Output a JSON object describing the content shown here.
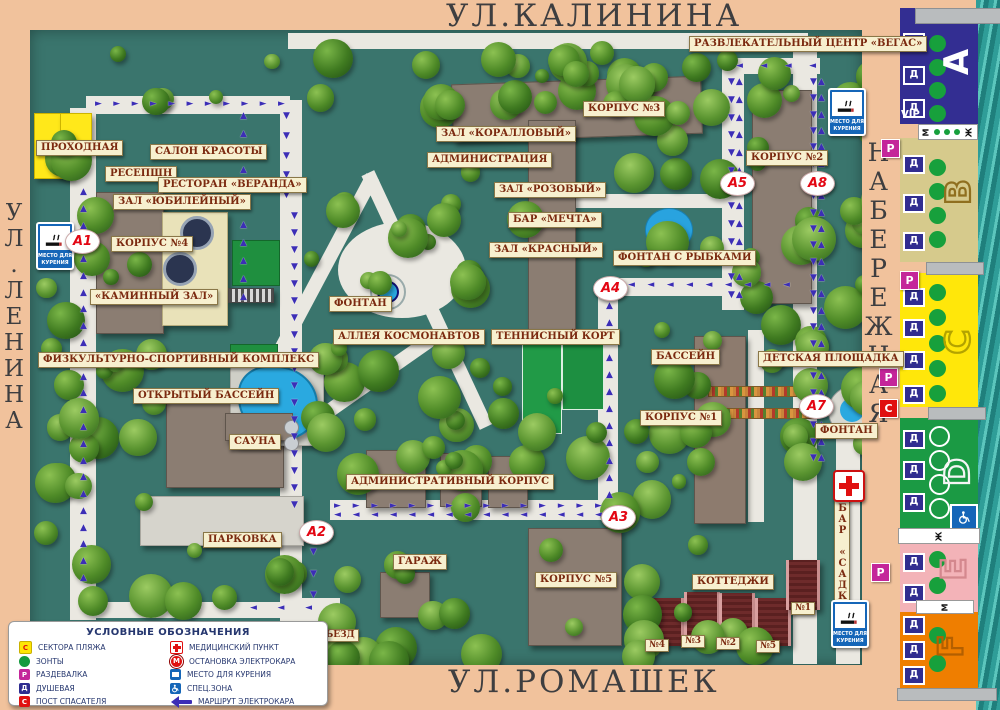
{
  "streets": {
    "top": "УЛ.КАЛИНИНА",
    "left": "УЛ.ЛЕНИНА",
    "right": "НАБЕРЕЖНАЯ",
    "bottom": "УЛ.РОМАШЕК"
  },
  "map": {
    "labels": [
      {
        "id": "prohodnaya",
        "text": "ПРОХОДНАЯ"
      },
      {
        "id": "salon",
        "text": "САЛОН КРАСОТЫ"
      },
      {
        "id": "reception",
        "text": "РЕСЕПШН"
      },
      {
        "id": "veranda",
        "text": "РЕСТОРАН «ВЕРАНДА»"
      },
      {
        "id": "yubileiny",
        "text": "ЗАЛ «ЮБИЛЕЙНЫЙ»"
      },
      {
        "id": "korpus4",
        "text": "КОРПУС №4"
      },
      {
        "id": "kaminny",
        "text": "«КАМИННЫЙ ЗАЛ»"
      },
      {
        "id": "sport",
        "text": "ФИЗКУЛЬТУРНО-СПОРТИВНЫЙ КОМПЛЕКС"
      },
      {
        "id": "openpool",
        "text": "ОТКРЫТЫЙ БАССЕЙН"
      },
      {
        "id": "sauna",
        "text": "САУНА"
      },
      {
        "id": "parking",
        "text": "ПАРКОВКА"
      },
      {
        "id": "korpus3",
        "text": "КОРПУС №3"
      },
      {
        "id": "korall",
        "text": "ЗАЛ «КОРАЛЛОВЫЙ»"
      },
      {
        "id": "admin",
        "text": "АДМИНИСТРАЦИЯ"
      },
      {
        "id": "rozovy",
        "text": "ЗАЛ «РОЗОВЫЙ»"
      },
      {
        "id": "mechta",
        "text": "БАР «МЕЧТА»"
      },
      {
        "id": "krasny",
        "text": "ЗАЛ «КРАСНЫЙ»"
      },
      {
        "id": "fontan-center",
        "text": "ФОНТАН"
      },
      {
        "id": "alleya",
        "text": "АЛЛЕЯ КОСМОНАВТОВ"
      },
      {
        "id": "tennis",
        "text": "ТЕННИСНЫЙ КОРТ"
      },
      {
        "id": "vegas",
        "text": "РАЗВЛЕКАТЕЛЬНЫЙ ЦЕНТР «ВЕГАС»"
      },
      {
        "id": "korpus2",
        "text": "КОРПУС №2"
      },
      {
        "id": "fontan-rybki",
        "text": "ФОНТАН С РЫБКАМИ"
      },
      {
        "id": "bassein",
        "text": "БАССЕЙН"
      },
      {
        "id": "detskaya",
        "text": "ДЕТСКАЯ ПЛОЩАДКА"
      },
      {
        "id": "korpus1",
        "text": "КОРПУС №1"
      },
      {
        "id": "fontan-right",
        "text": "ФОНТАН"
      },
      {
        "id": "admin-korpus",
        "text": "АДМИНИСТРАТИВНЫЙ КОРПУС"
      },
      {
        "id": "garage",
        "text": "ГАРАЖ"
      },
      {
        "id": "korpus5",
        "text": "КОРПУС №5"
      },
      {
        "id": "cottages",
        "text": "КОТТЕДЖИ"
      },
      {
        "id": "cottage-4",
        "text": "№4"
      },
      {
        "id": "cottage-3",
        "text": "№3"
      },
      {
        "id": "cottage-2",
        "text": "№2"
      },
      {
        "id": "cottage-5",
        "text": "№5"
      },
      {
        "id": "cottage-1",
        "text": "№1"
      },
      {
        "id": "bar-sadko",
        "text": "БАР «САДКО»"
      },
      {
        "id": "vezd",
        "text": "ВЪЕЗД"
      }
    ],
    "markers": [
      "А1",
      "А2",
      "А3",
      "А4",
      "А5",
      "А7",
      "А8"
    ],
    "signs": {
      "smoking": "МЕСТО ДЛЯ КУРЕНИЯ"
    }
  },
  "legend": {
    "title": "УСЛОВНЫЕ ОБОЗНАЧЕНИЯ",
    "columns": [
      [
        {
          "icon": "beach-sector",
          "badge": "С",
          "label": "СЕКТОРА ПЛЯЖА"
        },
        {
          "icon": "umbrella",
          "badge": "",
          "label": "ЗОНТЫ"
        },
        {
          "icon": "changing-room",
          "badge": "Р",
          "label": "РАЗДЕВАЛКА"
        },
        {
          "icon": "shower",
          "badge": "Д",
          "label": "ДУШЕВАЯ"
        },
        {
          "icon": "lifeguard",
          "badge": "С",
          "label": "ПОСТ СПАСАТЕЛЯ"
        }
      ],
      [
        {
          "icon": "medical",
          "badge": "",
          "label": "МЕДИЦИНСКИЙ ПУНКТ"
        },
        {
          "icon": "electrocar-stop",
          "badge": "М",
          "label": "ОСТАНОВКА ЭЛЕКТРОКАРА"
        },
        {
          "icon": "smoking",
          "badge": "",
          "label": "МЕСТО ДЛЯ КУРЕНИЯ"
        },
        {
          "icon": "special-zone",
          "badge": "",
          "label": "СПЕЦ.ЗОНА"
        },
        {
          "icon": "electrocar-route",
          "badge": "",
          "label": "МАРШРУТ ЭЛЕКТРОКАРА"
        }
      ]
    ]
  },
  "beach": {
    "shower_badge": "Д",
    "vip": "VIP",
    "wc": {
      "m": "М",
      "f": "Ж"
    },
    "sectors": [
      {
        "letter": "А",
        "color": "#332e92",
        "showers": 3,
        "umbrellas": 4
      },
      {
        "letter": "В",
        "color": "#d6ca8c",
        "showers": 3,
        "umbrellas": 4
      },
      {
        "letter": "С",
        "color": "#ffe70a",
        "showers": 4,
        "umbrellas": 5
      },
      {
        "letter": "D",
        "color": "#1b9a44",
        "showers": 3,
        "umbrellas": 4
      },
      {
        "letter": "Е",
        "color": "#f3b3b8",
        "showers": 2,
        "umbrellas": 2
      },
      {
        "letter": "F",
        "color": "#ef7e00",
        "showers": 3,
        "umbrellas": 2
      }
    ],
    "edge_badges": [
      "Р",
      "Р",
      "Р",
      "С",
      "Р"
    ]
  }
}
